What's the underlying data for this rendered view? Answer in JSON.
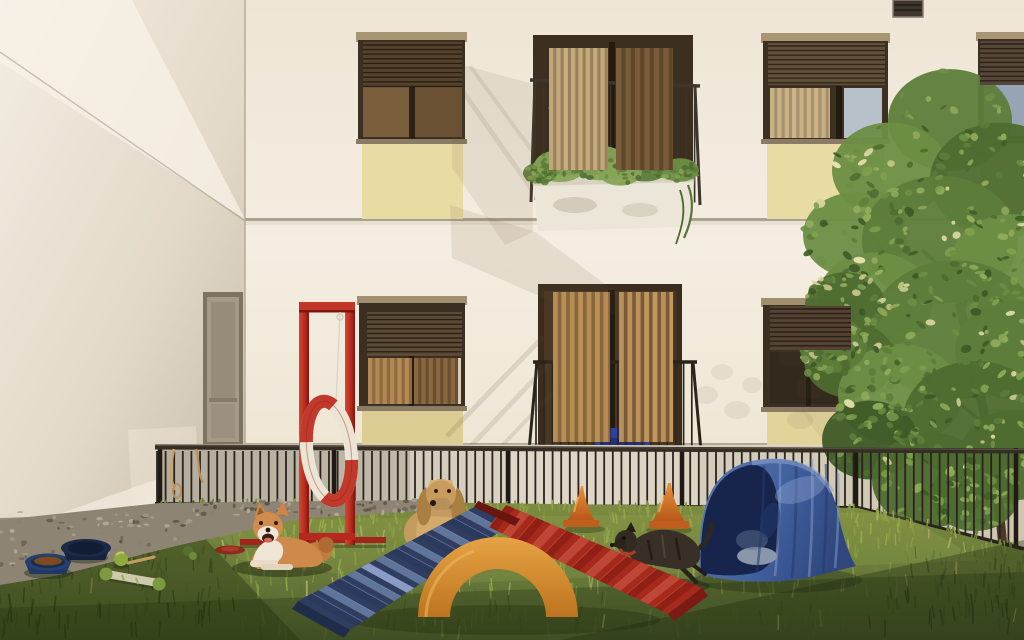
{
  "scene": {
    "aria_label": "Sunny residential courtyard converted into a dog playground with three dogs, agility equipment and a leafy tree",
    "setting": "residential courtyard pet play area",
    "building": {
      "facade_color": "#f2ebdf",
      "facade_shade": "#e9e0d1",
      "side_wall_color": "#ece4d6",
      "side_wall_shade": "#cfc5b4",
      "floor_band_color": "#aba18f",
      "accent_panel_color": "#e9dba4",
      "window_frame_color": "#3c3022",
      "shutter_color": "#5a4833",
      "curtain_light": "#c4a873",
      "curtain_dark": "#8a6a42",
      "glass_sky": "#a7b3c0",
      "railing_color": "#332c22",
      "planter_color": "#ece6d9",
      "paving_color": "#d5cdbe",
      "elements": [
        "roller-shutter-window",
        "juliet-balcony",
        "flower-planter",
        "vent-grille",
        "mesh-door",
        "glass-balcony-door"
      ]
    },
    "enclosure": {
      "fence_color": "#2a241d",
      "gravel_color": "#938a7a",
      "grass_lit": "#8a9a49",
      "grass_mid": "#66783a",
      "grass_shadow": "#3c4c22"
    },
    "equipment": [
      {
        "name": "tire-jump-frame",
        "frame_color": "#b7291e",
        "ring_colors": [
          "#c0392b",
          "#ece5d6"
        ]
      },
      {
        "name": "a-frame-ramp",
        "left_color": "#2e3d60",
        "right_color": "#a52a1c",
        "arch_color": "#d98e33"
      },
      {
        "name": "training-cone",
        "color": "#d97a26",
        "count": 2
      },
      {
        "name": "agility-tunnel",
        "color": "#45639f",
        "interior": "#1c2a52"
      }
    ],
    "dogs": [
      {
        "name": "shiba-inu",
        "pose": "lying",
        "coat": "#d08a4d"
      },
      {
        "name": "cocker-spaniel",
        "pose": "standing-behind-ramp",
        "coat": "#c49a5e"
      },
      {
        "name": "brindle-dog",
        "pose": "running",
        "coat": "#383026"
      }
    ],
    "props": [
      {
        "name": "food-bowl",
        "color": "#26406f"
      },
      {
        "name": "water-bowl",
        "color": "#1d2a47"
      },
      {
        "name": "ball",
        "color": "#93a83e"
      },
      {
        "name": "rope-bone-toy",
        "color": "#cfc9ad"
      },
      {
        "name": "frisbee",
        "color": "#8e2a1c"
      },
      {
        "name": "leashes",
        "color": "#c8a26a"
      }
    ],
    "vegetation": {
      "tree": "linden tree",
      "tree_green": "#5d7d3a",
      "tree_flowers": "#d9d49b",
      "trunk": "#4a3926",
      "balcony_plants": "#5f7d3c"
    }
  },
  "render": {
    "seed": 7,
    "fence": {
      "x0": 157,
      "x1": 1022,
      "step": 8.6,
      "yTop": 451,
      "yBottom": 509,
      "slopeStartX": 860,
      "slope": 0.3,
      "bar": "#2a241d",
      "barW": 1.8,
      "posts": [
        160,
        334,
        508,
        682,
        856,
        1016
      ],
      "post": "#1f1a14",
      "postW": 4.5
    },
    "railings": [
      {
        "x0": 535,
        "x1": 696,
        "yT": 82,
        "yB": 200,
        "step": 8.4,
        "slope": 0.04,
        "color": "#3a3329",
        "w": 1.6
      },
      {
        "x0": 536,
        "x1": 694,
        "yT": 363,
        "yB": 449,
        "step": 8.2,
        "slope": 0,
        "color": "#2c261d",
        "w": 1.7
      }
    ],
    "shutters": [
      {
        "x": 363,
        "y": 42,
        "w": 99,
        "h": 45,
        "base": "#55422d",
        "line": "#2a1f12"
      },
      {
        "x": 768,
        "y": 43,
        "w": 117,
        "h": 42,
        "base": "#60503a",
        "line": "#302518"
      },
      {
        "x": 980,
        "y": 41,
        "w": 44,
        "h": 44,
        "base": "#57473a",
        "line": "#2b2115"
      },
      {
        "x": 367,
        "y": 312,
        "w": 95,
        "h": 44,
        "base": "#5b4a36",
        "line": "#2c2115"
      },
      {
        "x": 770,
        "y": 306,
        "w": 81,
        "h": 44,
        "base": "#544334",
        "line": "#291f13"
      }
    ],
    "curtains": [
      {
        "x": 549,
        "y": 48,
        "w": 59,
        "h": 122,
        "a": "#c7ae80",
        "b": "#99805a",
        "step": 7
      },
      {
        "x": 616,
        "y": 48,
        "w": 57,
        "h": 122,
        "a": "#7b5e3d",
        "b": "#5e4728",
        "step": 9
      },
      {
        "x": 553,
        "y": 292,
        "w": 57,
        "h": 150,
        "a": "#b99158",
        "b": "#8a663c",
        "step": 8
      },
      {
        "x": 619,
        "y": 292,
        "w": 54,
        "h": 150,
        "a": "#c09a60",
        "b": "#7d5a35",
        "step": 8
      },
      {
        "x": 770,
        "y": 88,
        "w": 60,
        "h": 50,
        "a": "#cbb48a",
        "b": "#a8906a",
        "step": 7
      },
      {
        "x": 368,
        "y": 358,
        "w": 44,
        "h": 46,
        "a": "#b58d5c",
        "b": "#90683c",
        "step": 7
      },
      {
        "x": 414,
        "y": 358,
        "w": 44,
        "h": 46,
        "a": "#8a6a42",
        "b": "#6b4e2e",
        "step": 7
      }
    ],
    "ramps": [
      {
        "p1": [
          482,
          503
        ],
        "p2": [
          516,
          521
        ],
        "q1": [
          298,
          601
        ],
        "q2": [
          350,
          630
        ],
        "n": 13,
        "light": "#66799f",
        "dark": "#2b3a5c",
        "bright": "#93a3cf"
      },
      {
        "p1": [
          506,
          505
        ],
        "p2": [
          489,
          527
        ],
        "q1": [
          702,
          588
        ],
        "q2": [
          668,
          614
        ],
        "n": 13,
        "light": "#c04936",
        "dark": "#8e2015",
        "bright": "#d4664d"
      }
    ],
    "grass": {
      "count": 1050,
      "palette": [
        "#39481f",
        "#4a5c29",
        "#5c7032",
        "#6d8139",
        "#7f9342",
        "#90a34b",
        "#a2b256"
      ],
      "dry": "#a8a55e"
    },
    "pebbles": {
      "count": 170,
      "colors": [
        "#6e6557",
        "#8a8171",
        "#a59b89",
        "#5a5347",
        "#b5ab98"
      ]
    },
    "tree": {
      "count": 560,
      "blobs": [
        [
          950,
          120,
          62
        ],
        [
          890,
          170,
          58
        ],
        [
          1000,
          180,
          70
        ],
        [
          855,
          235,
          52
        ],
        [
          940,
          240,
          78
        ],
        [
          1012,
          265,
          62
        ],
        [
          875,
          300,
          58
        ],
        [
          955,
          330,
          85
        ],
        [
          1015,
          350,
          60
        ],
        [
          850,
          360,
          46
        ],
        [
          900,
          395,
          62
        ],
        [
          975,
          420,
          72
        ],
        [
          1015,
          455,
          55
        ],
        [
          870,
          440,
          48
        ],
        [
          930,
          480,
          58
        ],
        [
          975,
          495,
          44
        ],
        [
          845,
          305,
          40
        ],
        [
          833,
          345,
          34
        ]
      ],
      "greens": [
        "#3f5a28",
        "#4e6c30",
        "#5d7d3a",
        "#6d8e44",
        "#7fa04f",
        "#92ab5c"
      ],
      "flowers": [
        "#d9d49b",
        "#e6e0ae",
        "#c9c687"
      ]
    },
    "planter": {
      "count": 150,
      "blobs": [
        [
          560,
          166,
          26
        ],
        [
          600,
          163,
          28
        ],
        [
          645,
          166,
          25
        ],
        [
          540,
          173,
          17
        ],
        [
          680,
          170,
          19
        ],
        [
          620,
          172,
          22
        ]
      ],
      "greens": [
        "#4e6c30",
        "#5d7d3a",
        "#6d8e44",
        "#86a456"
      ]
    },
    "tunnelFolds": [
      [
        764,
        466,
        757,
        572
      ],
      [
        780,
        463,
        775,
        576
      ],
      [
        796,
        461,
        792,
        578
      ],
      [
        812,
        459,
        809,
        577
      ],
      [
        826,
        464,
        823,
        573
      ],
      [
        838,
        473,
        835,
        568
      ]
    ]
  }
}
